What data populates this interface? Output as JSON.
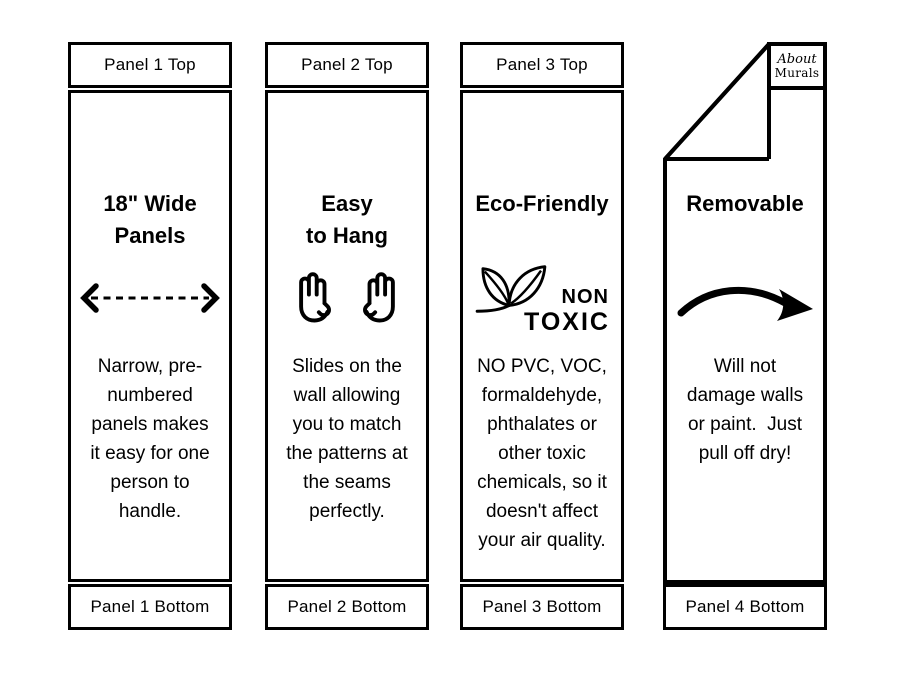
{
  "colors": {
    "ink": "#000000",
    "paper": "#ffffff"
  },
  "logo": {
    "line1": "About",
    "line2": "Murals"
  },
  "panels": [
    {
      "top_label": "Panel 1 Top",
      "title": "18\" Wide\nPanels",
      "icon": "width-double-arrow-icon",
      "body": "Narrow, pre-\nnumbered\npanels makes\nit easy for one\nperson to\nhandle.",
      "bottom_label": "Panel 1 Bottom"
    },
    {
      "top_label": "Panel 2 Top",
      "title": "Easy\nto Hang",
      "icon": "two-hands-icon",
      "body": "Slides on the\nwall allowing\nyou to match\nthe patterns at\nthe seams\nperfectly.",
      "bottom_label": "Panel 2 Bottom"
    },
    {
      "top_label": "Panel 3 Top",
      "title": "Eco-Friendly",
      "icon": "non-toxic-leaf-icon",
      "non_toxic_line1": "NON",
      "non_toxic_line2": "TOXIC",
      "body": "NO PVC, VOC,\nformaldehyde,\nphthalates or\nother toxic\nchemicals, so it\ndoesn't affect\nyour air quality.",
      "bottom_label": "Panel 3 Bottom"
    },
    {
      "title": "Removable",
      "icon": "curved-arrow-icon",
      "body": "Will not\ndamage walls\nor paint.  Just\npull off dry!",
      "bottom_label": "Panel 4 Bottom"
    }
  ]
}
